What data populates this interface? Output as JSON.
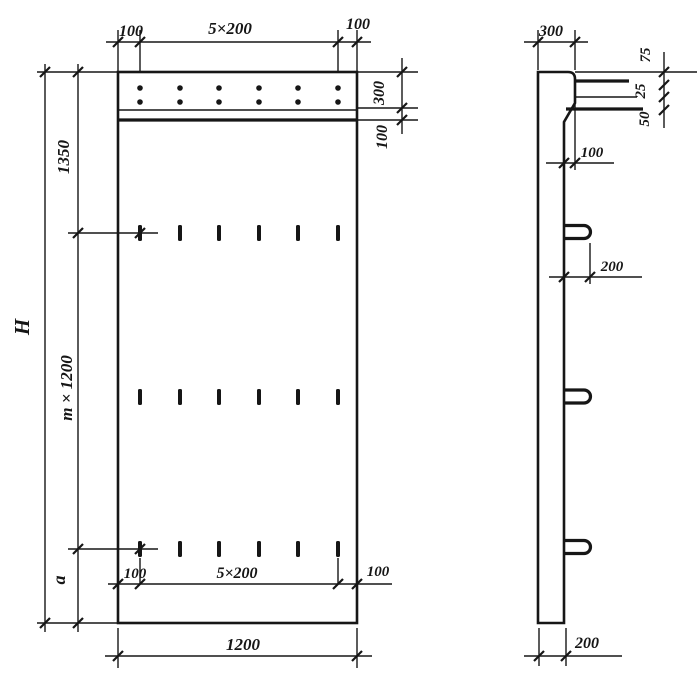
{
  "drawing": {
    "ink_color": "#161616",
    "paper_color": "#ffffff",
    "front": {
      "top_dim": {
        "left": "100",
        "mid": "5×200",
        "right": "100"
      },
      "left_dims": {
        "overall": "H",
        "upper": "1350",
        "middle": "m × 1200",
        "lower": "a"
      },
      "right_dims": {
        "band": "300",
        "groove": "100"
      },
      "inner_bottom_dim": {
        "left": "100",
        "mid": "5×200",
        "right": "100"
      },
      "overall_width": "1200"
    },
    "side": {
      "top_width": "300",
      "ledge_dims": {
        "first": "75",
        "second": "25",
        "third": "50"
      },
      "ledge_offset": "100",
      "loop_length": "200",
      "base_thickness": "200"
    }
  }
}
